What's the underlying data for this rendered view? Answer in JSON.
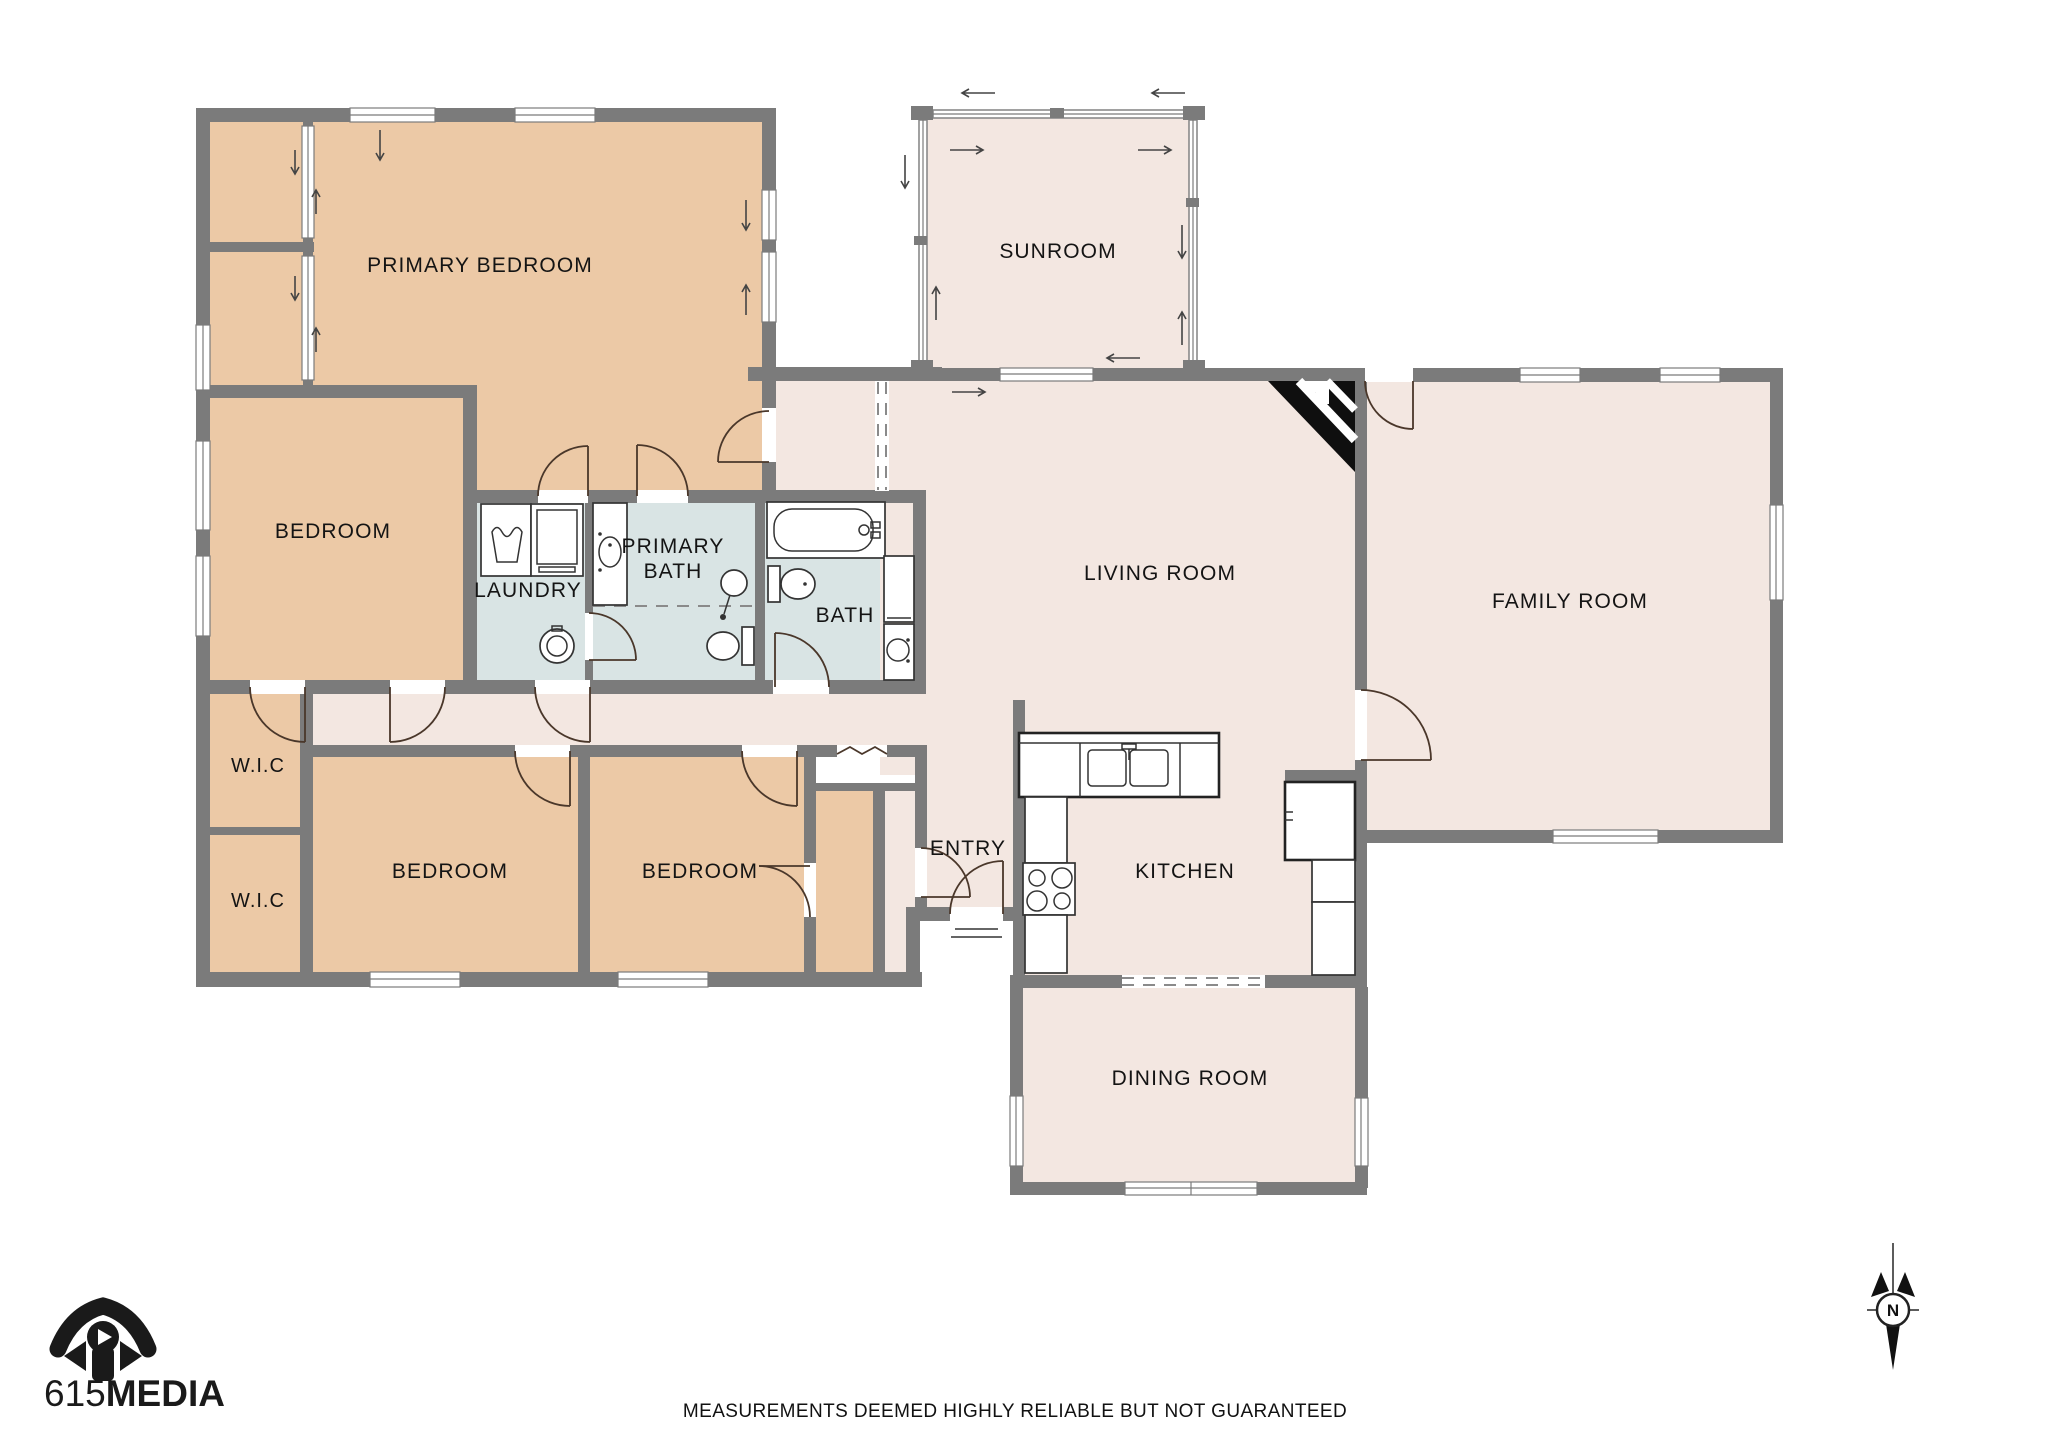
{
  "palette": {
    "wall": "#7b7b7b",
    "bedroom_fill": "#ecc9a6",
    "living_fill": "#f3e7e1",
    "bath_fill": "#d9e4e4",
    "fixture_outline": "#333333",
    "door_arc": "#4a372a",
    "label_color": "#141414",
    "fireplace": "#0f0f0f",
    "background": "#ffffff"
  },
  "rooms": {
    "primary_bedroom": {
      "label": "PRIMARY BEDROOM"
    },
    "sunroom": {
      "label": "SUNROOM"
    },
    "family_room": {
      "label": "FAMILY ROOM"
    },
    "living_room": {
      "label": "LIVING ROOM"
    },
    "bedroom_left": {
      "label": "BEDROOM"
    },
    "laundry": {
      "label": "LAUNDRY"
    },
    "primary_bath": {
      "line1": "PRIMARY",
      "line2": "BATH"
    },
    "bath": {
      "label": "BATH"
    },
    "wic_upper": {
      "label": "W.I.C"
    },
    "wic_lower": {
      "label": "W.I.C"
    },
    "bedroom_bottom_left": {
      "label": "BEDROOM"
    },
    "bedroom_bottom_right": {
      "label": "BEDROOM"
    },
    "entry": {
      "label": "ENTRY"
    },
    "kitchen": {
      "label": "KITCHEN"
    },
    "dining_room": {
      "label": "DINING ROOM"
    }
  },
  "branding": {
    "logo_number": "615",
    "logo_word": "MEDIA"
  },
  "compass": {
    "north_label": "N"
  },
  "footer": {
    "disclaimer": "MEASUREMENTS DEEMED HIGHLY RELIABLE BUT NOT GUARANTEED"
  }
}
